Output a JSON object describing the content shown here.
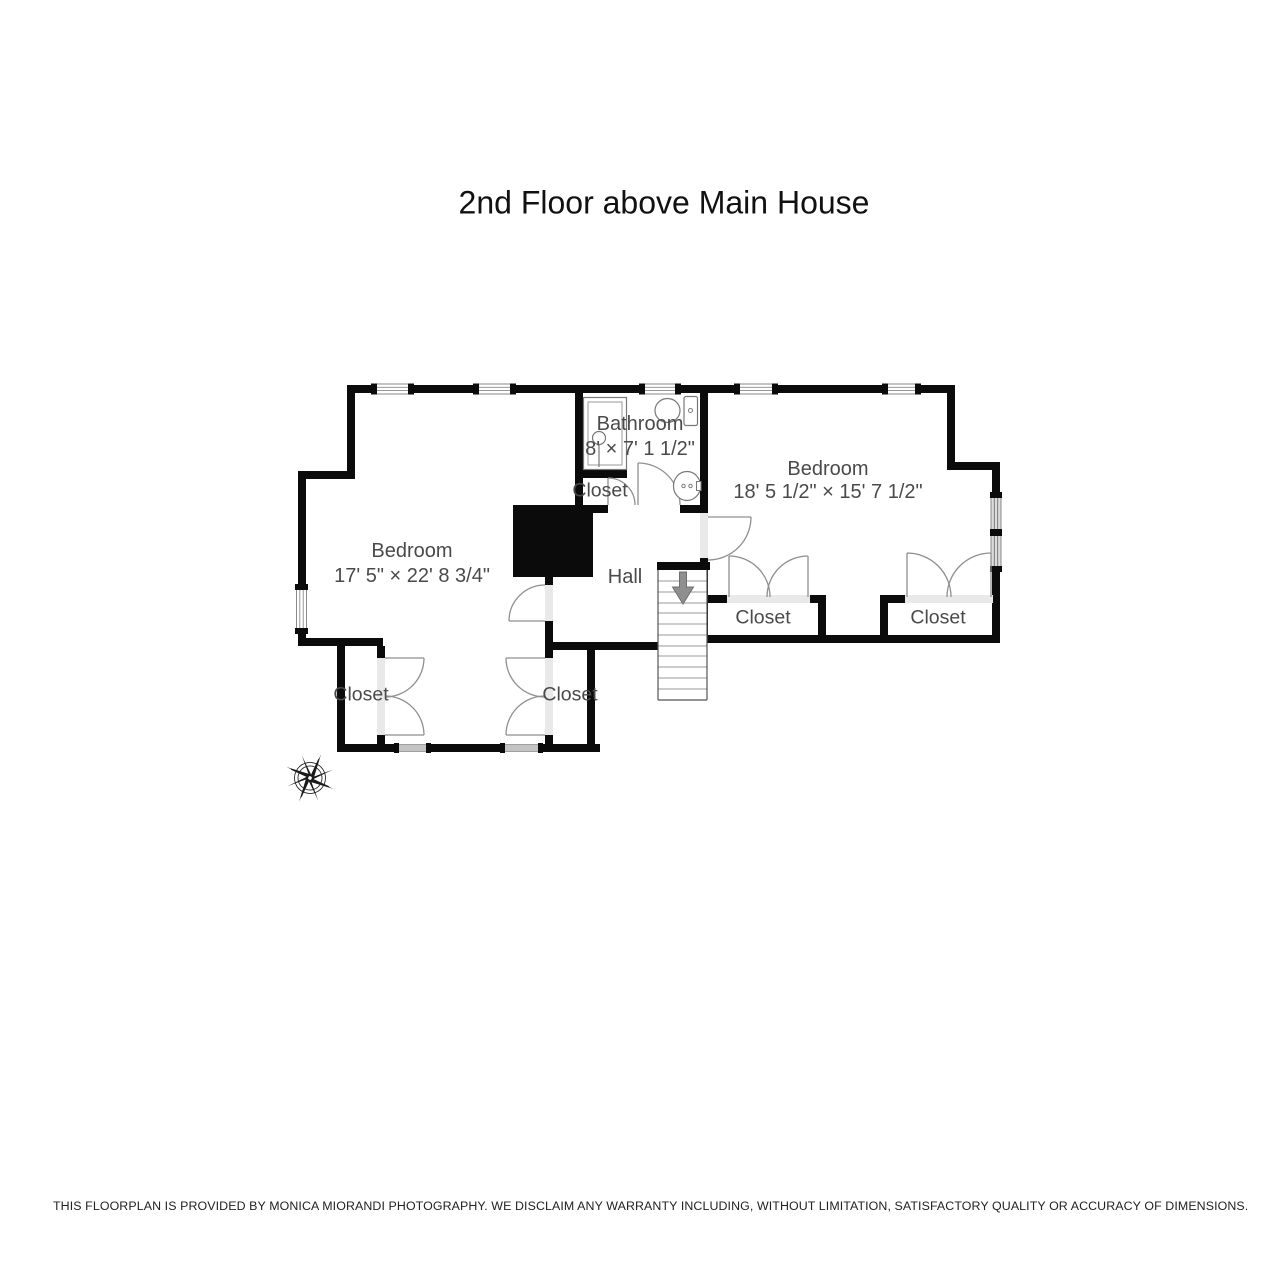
{
  "title": "2nd Floor above Main House",
  "rooms": {
    "bedroom_left": {
      "name": "Bedroom",
      "dimensions": "17' 5\" × 22' 8 3/4\""
    },
    "bedroom_right": {
      "name": "Bedroom",
      "dimensions": "18' 5 1/2\" × 15' 7 1/2\""
    },
    "bathroom": {
      "name": "Bathroom",
      "dimensions": "8' × 7' 1 1/2\""
    },
    "hall": {
      "name": "Hall"
    },
    "closets": [
      "Closet",
      "Closet",
      "Closet",
      "Closet",
      "Closet"
    ]
  },
  "footer": "THIS FLOORPLAN IS PROVIDED BY MONICA MIORANDI PHOTOGRAPHY. WE DISCLAIM ANY WARRANTY INCLUDING, WITHOUT LIMITATION, SATISFACTORY QUALITY OR ACCURACY OF DIMENSIONS.",
  "colors": {
    "wall": "#0b0b0b",
    "label_text": "#4a4a4a",
    "door_swing": "#8f8f8f",
    "threshold": "#e9e9e9",
    "window_gray": "#c4c4c4",
    "stair_arrow": "#8f8f8f"
  }
}
